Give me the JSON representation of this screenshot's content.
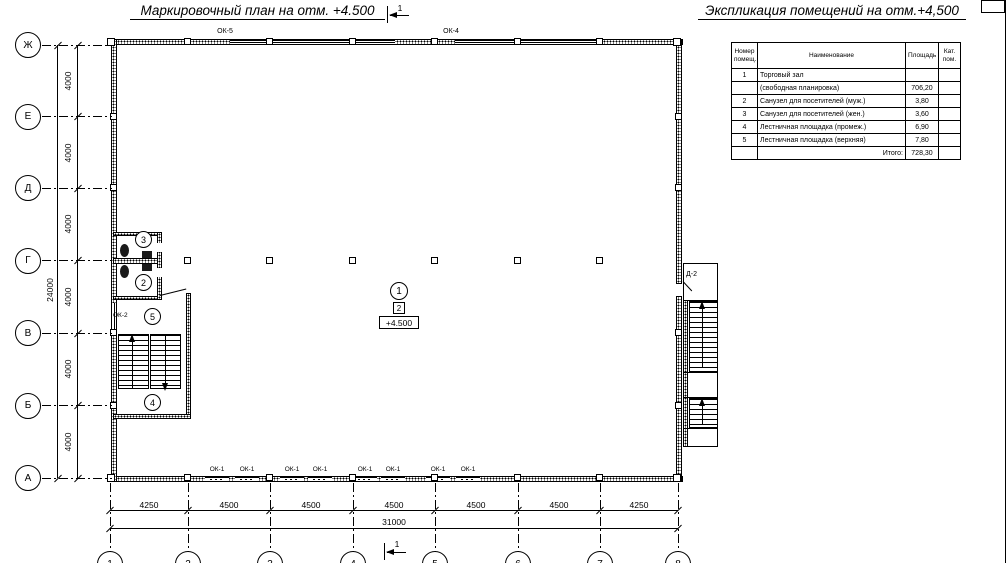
{
  "titles": {
    "plan": "Маркировочный план на отм. +4.500",
    "schedule": "Экспликация помещений на отм.+4,500"
  },
  "section_mark": {
    "label": "1"
  },
  "grid": {
    "row_labels": [
      "Ж",
      "Е",
      "Д",
      "Г",
      "В",
      "Б",
      "А"
    ],
    "col_labels": [
      "1",
      "2",
      "3",
      "4",
      "5",
      "6",
      "7",
      "8"
    ]
  },
  "dimensions": {
    "left_segments": [
      "4000",
      "4000",
      "4000",
      "4000",
      "4000",
      "4000"
    ],
    "left_total": "24000",
    "bottom_segments": [
      "4250",
      "4500",
      "4500",
      "4500",
      "4500",
      "4500",
      "4250"
    ],
    "bottom_total": "31000"
  },
  "labels": {
    "ok1": "ОК-1",
    "ok2": "ОК-2",
    "ok4": "ОК-4",
    "ok5": "ОК-5",
    "d2": "Д-2",
    "plan_square": "2",
    "elevation": "+4.500"
  },
  "rooms": {
    "bubbles": [
      "1",
      "2",
      "3",
      "4",
      "5"
    ]
  },
  "schedule": {
    "headers": {
      "num": "Номер\nпомещ.",
      "name": "Наименование",
      "area": "Площадь",
      "cat": "Кат.\nпом."
    },
    "rows": [
      {
        "num": "1",
        "name": "Торговый зал",
        "area": "",
        "cat": ""
      },
      {
        "num": "",
        "name": "(свободная планировка)",
        "area": "706,20",
        "cat": ""
      },
      {
        "num": "2",
        "name": "Санузел для посетителей (муж.)",
        "area": "3,80",
        "cat": ""
      },
      {
        "num": "3",
        "name": "Санузел для посетителей (жен.)",
        "area": "3,60",
        "cat": ""
      },
      {
        "num": "4",
        "name": "Лестничная площадка (промеж.)",
        "area": "6,90",
        "cat": ""
      },
      {
        "num": "5",
        "name": "Лестничная площадка (верхняя)",
        "area": "7,80",
        "cat": ""
      }
    ],
    "total_label": "Итого:",
    "total_value": "728,30"
  }
}
